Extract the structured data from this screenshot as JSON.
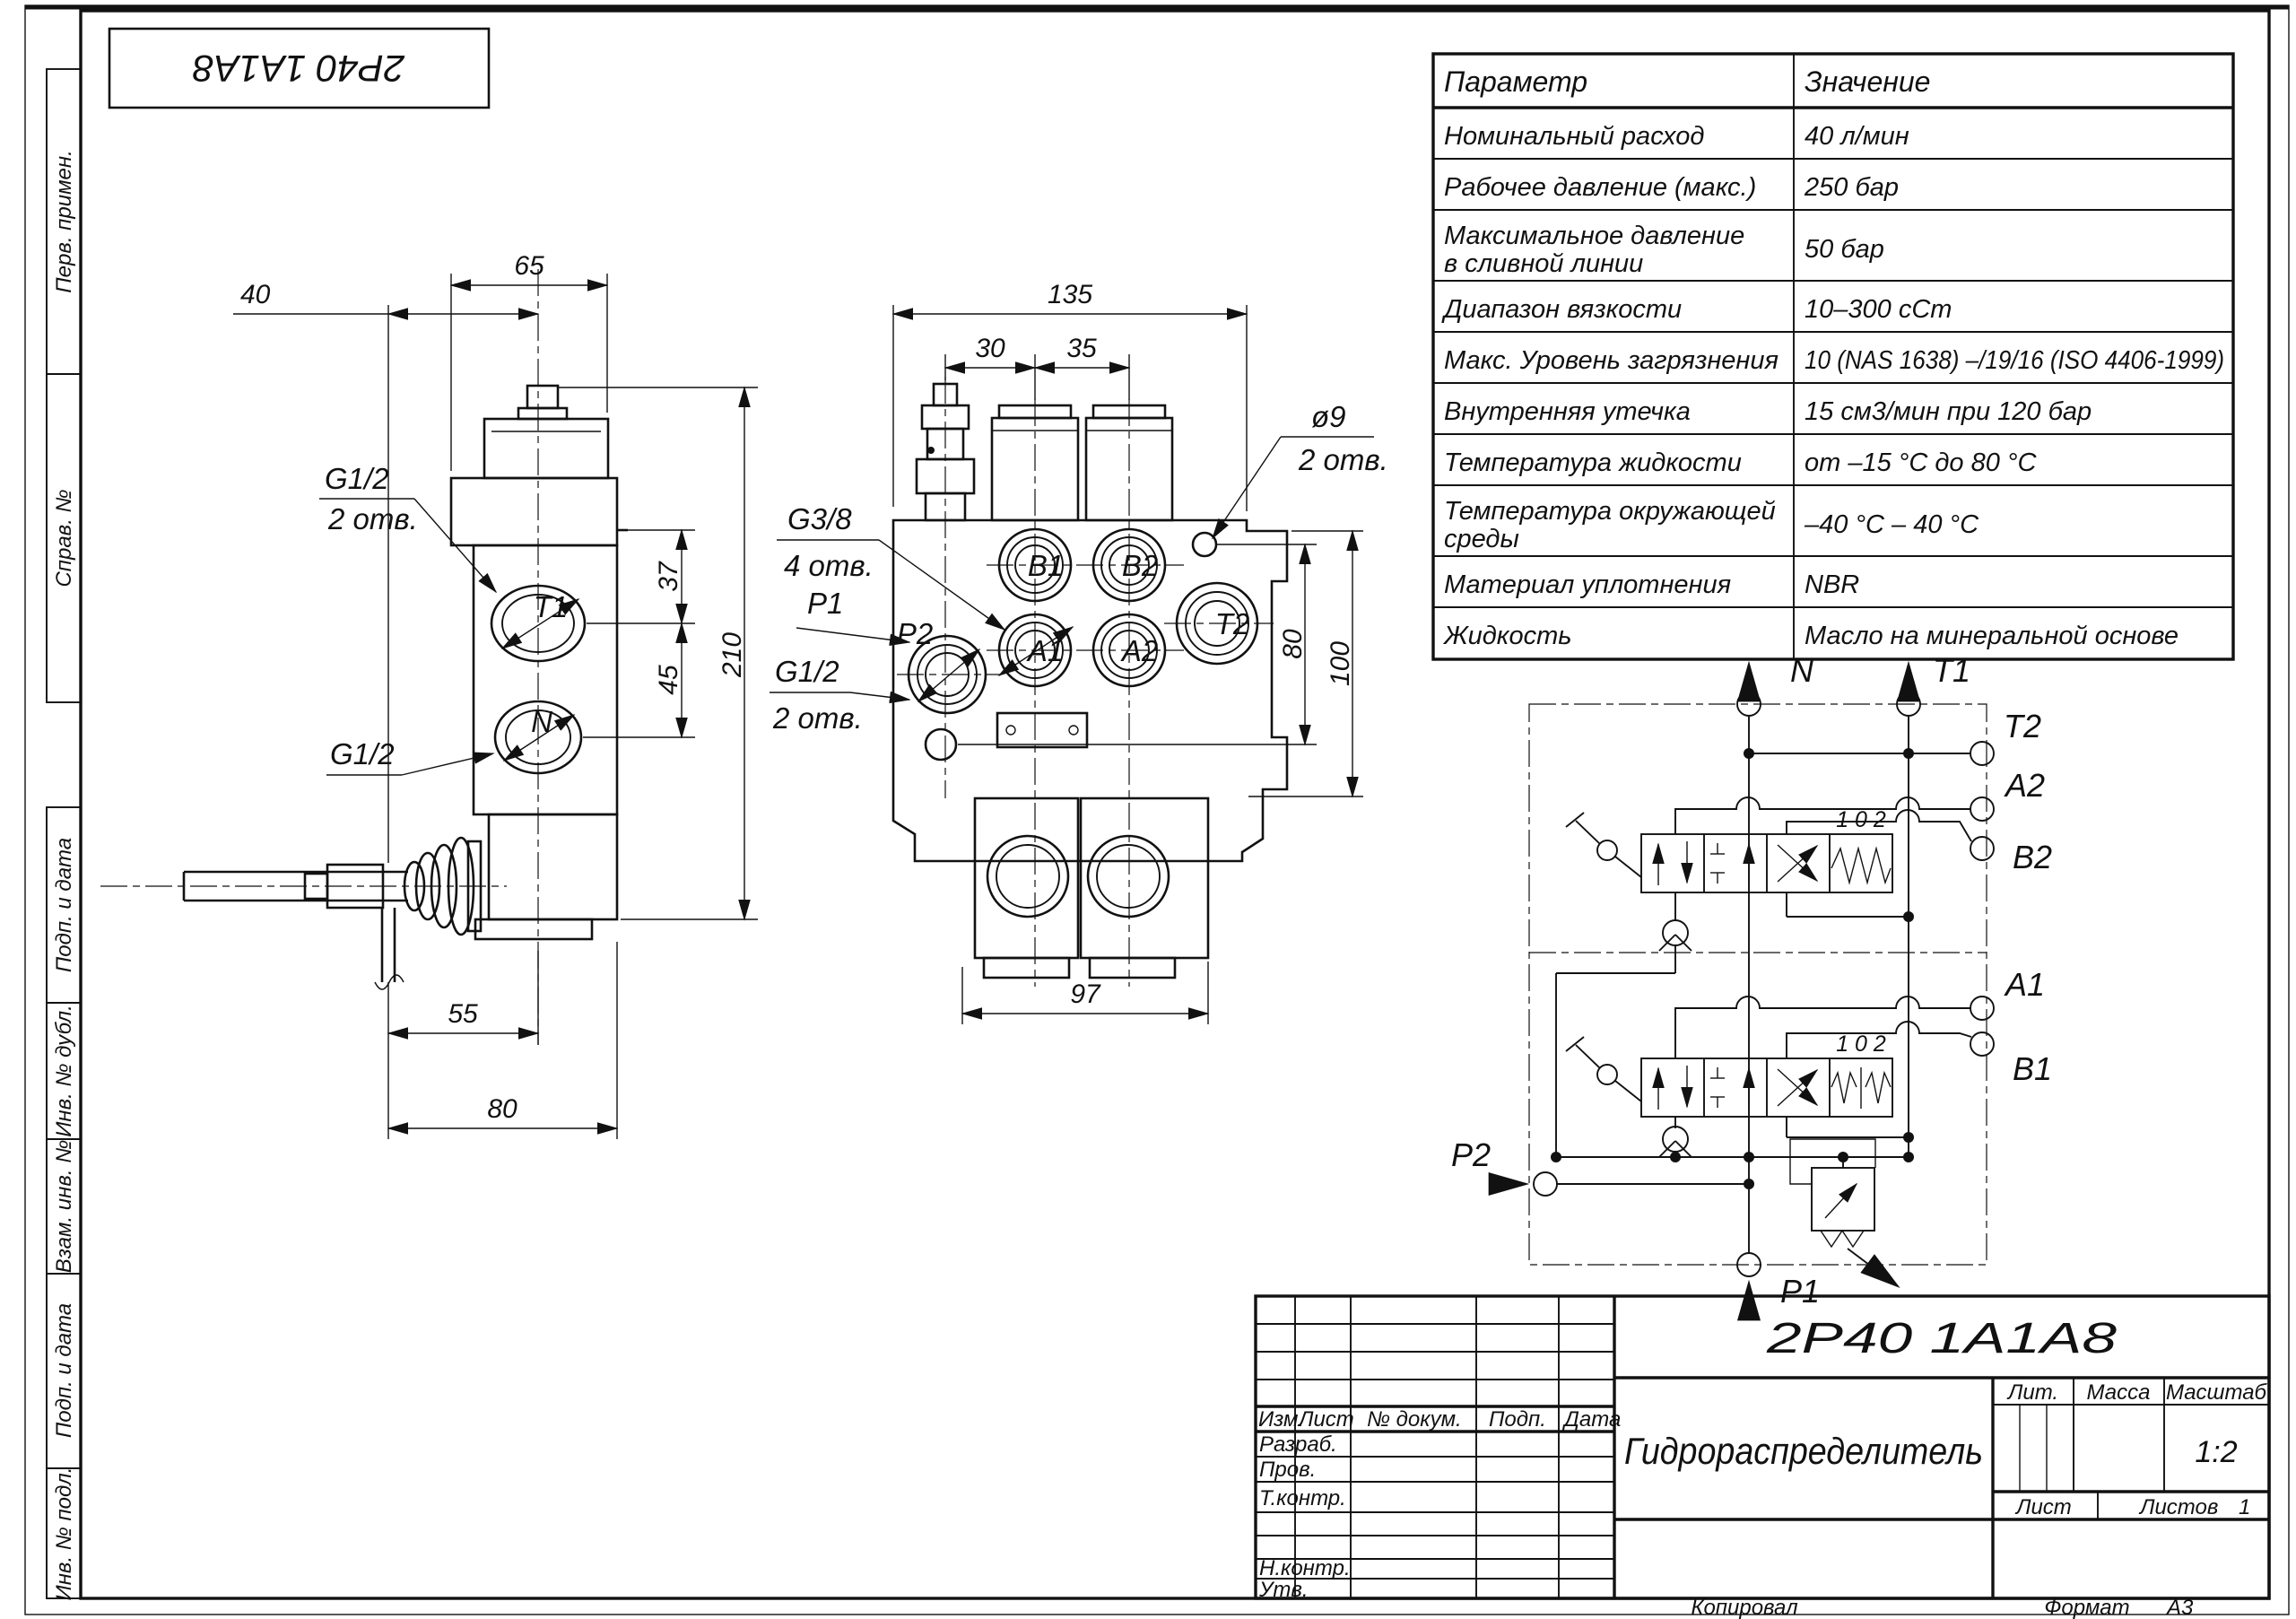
{
  "frame": {
    "stamp": "2Р40 1А1А8"
  },
  "side_column": {
    "items": [
      "Перв. примен.",
      "Справ. №",
      "Подп. и дата",
      "Инв. № дубл.",
      "Взам. инв. №",
      "Подп. и дата",
      "Инв. № подл."
    ]
  },
  "params_table": {
    "col_param": "Параметр",
    "col_value": "Значение",
    "rows": [
      {
        "p": "Номинальный расход",
        "v": "40 л/мин"
      },
      {
        "p": "Рабочее давление (макс.)",
        "v": "250 бар"
      },
      {
        "p": "Максимальное давление",
        "p2": "в сливной линии",
        "v": "50 бар"
      },
      {
        "p": "Диапазон вязкости",
        "v": "10–300 сСт"
      },
      {
        "p": "Макс. Уровень загрязнения",
        "v": "10 (NAS 1638) –/19/16 (ISO 4406-1999)"
      },
      {
        "p": "Внутренняя утечка",
        "v": "15 см3/мин при 120 бар"
      },
      {
        "p": "Температура жидкости",
        "v": "от –15 °С до 80 °С"
      },
      {
        "p": "Температура окружающей",
        "p2": "среды",
        "v": "–40 °С – 40 °С"
      },
      {
        "p": "Материал уплотнения",
        "v": "NBR"
      },
      {
        "p": "Жидкость",
        "v": "Масло на минеральной основе"
      }
    ]
  },
  "side_view": {
    "dim65": "65",
    "dim40": "40",
    "dim37": "37",
    "dim45": "45",
    "dim210": "210",
    "dim55": "55",
    "dim80": "80",
    "port_t1": "T1",
    "port_n": "N",
    "thread_top": "G1/2",
    "thread_top_qty": "2 отв.",
    "thread_bottom": "G1/2"
  },
  "front_view": {
    "dim135": "135",
    "dim30": "30",
    "dim35": "35",
    "dim80": "80",
    "dim100": "100",
    "dim97": "97",
    "hole_dia": "ø9",
    "hole_qty": "2 отв.",
    "thread_g38": "G3/8",
    "thread_g38_qty": "4 отв.",
    "port_p1": "P1",
    "thread_g12": "G1/2",
    "thread_g12_qty": "2 отв.",
    "ports": {
      "b1": "B1",
      "b2": "B2",
      "a1": "A1",
      "a2": "A2",
      "t2": "T2",
      "p2": "P2"
    }
  },
  "schematic": {
    "port_n": "N",
    "port_t1": "T1",
    "port_t2": "T2",
    "port_a2": "A2",
    "port_b2": "B2",
    "port_a1": "A1",
    "port_b1": "B1",
    "port_p2": "P2",
    "port_p1": "P1",
    "positions_upper": "1 0 2",
    "positions_lower": "1 0 2"
  },
  "title_block": {
    "designation": "2Р40 1А1А8",
    "doc_name": "Гидрораспределитель",
    "h_izm": "Изм.",
    "h_list": "Лист",
    "h_ndoc": "№ докум.",
    "h_podp": "Подп.",
    "h_data": "Дата",
    "r_razrab": "Разраб.",
    "r_prov": "Пров.",
    "r_tkontr": "Т.контр.",
    "r_nkontr": "Н.контр.",
    "r_utv": "Утв.",
    "lit": "Лит.",
    "massa": "Масса",
    "masshtab": "Масштаб",
    "scale_val": "1:2",
    "list_label": "Лист",
    "listov_label": "Листов",
    "listov_val": "1",
    "kopiroval": "Копировал",
    "format_label": "Формат",
    "format_val": "А3"
  }
}
